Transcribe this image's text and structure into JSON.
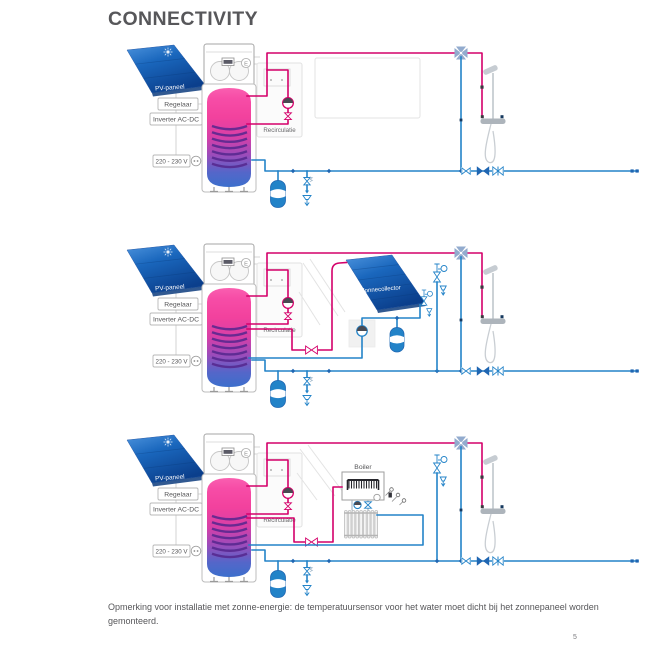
{
  "page": {
    "title": "CONNECTIVITY",
    "note": "Opmerking voor installatie met zonne-energie: de temperatuursensor voor het water moet dicht bij het zonnepaneel worden gemonteerd.",
    "page_number": "5"
  },
  "diagram_labels": {
    "pv_panel": "PV-paneel",
    "controller": "Regelaar",
    "inverter": "Inverter AC-DC",
    "mains_voltage": "220 - 230 V",
    "recirculation": "Recirculatie",
    "solar_collector": "Zonnecollector",
    "boiler": "Boiler",
    "energy_label": "E"
  },
  "colors": {
    "hot_pipe": "#d4006a",
    "cold_pipe": "#2383c8",
    "pipe_joint": "#1f66b2",
    "panel_blue": "#1863b8",
    "panel_blue_dark": "#0b3f8c",
    "title_text": "#57575a",
    "body_text": "#57575a",
    "ghost_gray": "#e3e3e3"
  }
}
